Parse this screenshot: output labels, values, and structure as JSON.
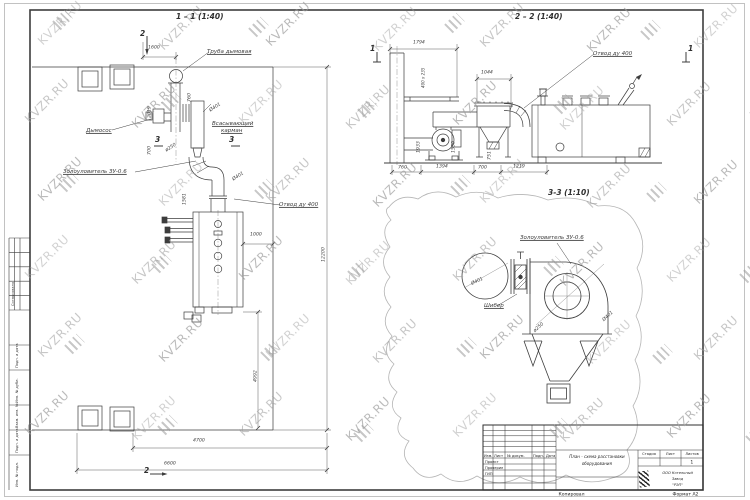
{
  "watermark": {
    "text": "KVZR.RU",
    "color": "#9d9d9d"
  },
  "views": {
    "plan_title": "1 – 1 (1:40)",
    "elevation_title": "2 – 2 (1:40)",
    "detail_title": "3-3 (1:10)"
  },
  "title_block": {
    "cols": {
      "izm": "Изм.",
      "list": "Лист",
      "ndoc": "№ докум.",
      "podp": "Подп.",
      "data": "Дата"
    },
    "roles": [
      "Проект",
      "Проверил",
      "ГИП"
    ],
    "title_line1": "План - схема расстановки",
    "title_line2": "оборудования",
    "stage_label": "Стадия",
    "sheet_label": "Лист",
    "sheets_label": "Листов",
    "sheets_value": "1",
    "company_line1": "ООО Котельный",
    "company_line2": "Завод",
    "company_line3": "\"РЭП\"",
    "copied_label": "Копировал",
    "format_label": "Формат А2"
  },
  "annotations": [
    {
      "n": "view-1-1-title",
      "t": "1 – 1 (1:40)",
      "x": 176,
      "y": 12,
      "c": "vtitle"
    },
    {
      "n": "view-2-2-title",
      "t": "2 – 2 (1:40)",
      "x": 515,
      "y": 12,
      "c": "vtitle"
    },
    {
      "n": "view-3-3-title",
      "t": "3-3 (1:10)",
      "x": 548,
      "y": 188,
      "c": "vtitle"
    },
    {
      "n": "label-chimney",
      "t": "Труба дымовая",
      "x": 207,
      "y": 48,
      "c": "label"
    },
    {
      "n": "label-fan",
      "t": "Дымосос",
      "x": 86,
      "y": 127,
      "c": "label"
    },
    {
      "n": "label-suction-1",
      "t": "Всасывающий",
      "x": 212,
      "y": 120,
      "c": "label"
    },
    {
      "n": "label-suction-2",
      "t": "карман",
      "x": 221,
      "y": 127,
      "c": "label"
    },
    {
      "n": "label-ash-plan",
      "t": "Золоуловитель ЗУ-0.6",
      "x": 63,
      "y": 168,
      "c": "label"
    },
    {
      "n": "label-otvod-plan",
      "t": "Отвод ду 400",
      "x": 279,
      "y": 201,
      "c": "label"
    },
    {
      "n": "label-otvod-elev",
      "t": "Отвод ду 400",
      "x": 593,
      "y": 50,
      "c": "label"
    },
    {
      "n": "label-ash-detail",
      "t": "Золоуловитель ЗУ-0.6",
      "x": 520,
      "y": 234,
      "c": "label"
    },
    {
      "n": "label-damper",
      "t": "Шибер",
      "x": 484,
      "y": 302,
      "c": "label"
    },
    {
      "n": "dim-1600",
      "t": "1600",
      "x": 148,
      "y": 44,
      "c": "dim"
    },
    {
      "n": "dim-760-plan",
      "t": "760",
      "x": 186,
      "y": 102,
      "r": -90,
      "c": "dim"
    },
    {
      "n": "dim-2019",
      "t": "2019",
      "x": 146,
      "y": 118,
      "r": -90,
      "c": "dim"
    },
    {
      "n": "dim-d401-plan1",
      "t": "Ø401",
      "x": 208,
      "y": 108,
      "r": -33,
      "c": "dim"
    },
    {
      "n": "dim-700-plan",
      "t": "700",
      "x": 146,
      "y": 155,
      "r": -90,
      "c": "dim"
    },
    {
      "n": "dim-d250-plan",
      "t": "ø250",
      "x": 164,
      "y": 148,
      "r": -33,
      "c": "dim"
    },
    {
      "n": "dim-d401-plan2",
      "t": "Ø401",
      "x": 231,
      "y": 177,
      "r": -33,
      "c": "dim"
    },
    {
      "n": "dim-1581",
      "t": "1581",
      "x": 181,
      "y": 205,
      "r": -90,
      "c": "dim"
    },
    {
      "n": "dim-1000-plan",
      "t": "1000",
      "x": 250,
      "y": 231,
      "c": "dim"
    },
    {
      "n": "dim-12200",
      "t": "12200",
      "x": 320,
      "y": 262,
      "r": -90,
      "c": "dim"
    },
    {
      "n": "dim-4992",
      "t": "4992",
      "x": 252,
      "y": 382,
      "r": -90,
      "c": "dim"
    },
    {
      "n": "dim-4700",
      "t": "4700",
      "x": 193,
      "y": 437,
      "c": "dim"
    },
    {
      "n": "dim-6600",
      "t": "6600",
      "x": 164,
      "y": 460,
      "c": "dim"
    },
    {
      "n": "dim-1794",
      "t": "1794",
      "x": 413,
      "y": 39,
      "c": "dim"
    },
    {
      "n": "dim-400x235",
      "t": "400 х 235",
      "x": 421,
      "y": 88,
      "r": -90,
      "c": "dim",
      "s": 0.62
    },
    {
      "n": "dim-1044",
      "t": "1044",
      "x": 481,
      "y": 69,
      "c": "dim"
    },
    {
      "n": "dim-1933",
      "t": "1933",
      "x": 415,
      "y": 153,
      "r": -90,
      "c": "dim"
    },
    {
      "n": "dim-1550",
      "t": "1550",
      "x": 450,
      "y": 153,
      "r": -90,
      "c": "dim"
    },
    {
      "n": "dim-751",
      "t": "751",
      "x": 486,
      "y": 160,
      "r": -90,
      "c": "dim"
    },
    {
      "n": "dim-760-elev",
      "t": "760",
      "x": 398,
      "y": 164,
      "c": "dim"
    },
    {
      "n": "dim-1394",
      "t": "1394",
      "x": 436,
      "y": 163,
      "c": "dim"
    },
    {
      "n": "dim-700-elev",
      "t": "700",
      "x": 478,
      "y": 164,
      "c": "dim"
    },
    {
      "n": "dim-1219",
      "t": "1219",
      "x": 513,
      "y": 163,
      "c": "dim"
    },
    {
      "n": "dim-d401-detail1",
      "t": "Ø401",
      "x": 470,
      "y": 281,
      "r": -25,
      "c": "dim"
    },
    {
      "n": "dim-d250-detail",
      "t": "ø250",
      "x": 532,
      "y": 329,
      "r": -42,
      "c": "dim"
    },
    {
      "n": "dim-d401-detail2",
      "t": "Ø401",
      "x": 601,
      "y": 318,
      "r": -42,
      "c": "dim"
    },
    {
      "n": "marker-2-top",
      "t": "2",
      "x": 140,
      "y": 29,
      "c": "marker"
    },
    {
      "n": "marker-3-left",
      "t": "3",
      "x": 155,
      "y": 135,
      "c": "marker"
    },
    {
      "n": "marker-3-right",
      "t": "3",
      "x": 229,
      "y": 135,
      "c": "marker"
    },
    {
      "n": "marker-1-left",
      "t": "1",
      "x": 370,
      "y": 44,
      "c": "marker"
    },
    {
      "n": "marker-1-right",
      "t": "1",
      "x": 688,
      "y": 44,
      "c": "marker"
    },
    {
      "n": "marker-2-bottom",
      "t": "2",
      "x": 144,
      "y": 466,
      "c": "marker"
    },
    {
      "n": "frame-soglasovano",
      "t": "Согласовано",
      "x": 11,
      "y": 306,
      "r": -90,
      "c": "frame",
      "s": 0.6
    },
    {
      "n": "frame-podp-data-1",
      "t": "Подп. и дата",
      "x": 15,
      "y": 368,
      "r": -90,
      "c": "frame",
      "s": 0.6
    },
    {
      "n": "frame-inv-dubl",
      "t": "Инв. № дубл.",
      "x": 15,
      "y": 403,
      "r": -90,
      "c": "frame",
      "s": 0.6
    },
    {
      "n": "frame-vzam-inv",
      "t": "Взам. инв. №",
      "x": 15,
      "y": 428,
      "r": -90,
      "c": "frame",
      "s": 0.6
    },
    {
      "n": "frame-podp-data-2",
      "t": "Подп. и дата",
      "x": 15,
      "y": 453,
      "r": -90,
      "c": "frame",
      "s": 0.6
    },
    {
      "n": "frame-inv-podl",
      "t": "Инв. № подл.",
      "x": 15,
      "y": 487,
      "r": -90,
      "c": "frame",
      "s": 0.6
    }
  ]
}
